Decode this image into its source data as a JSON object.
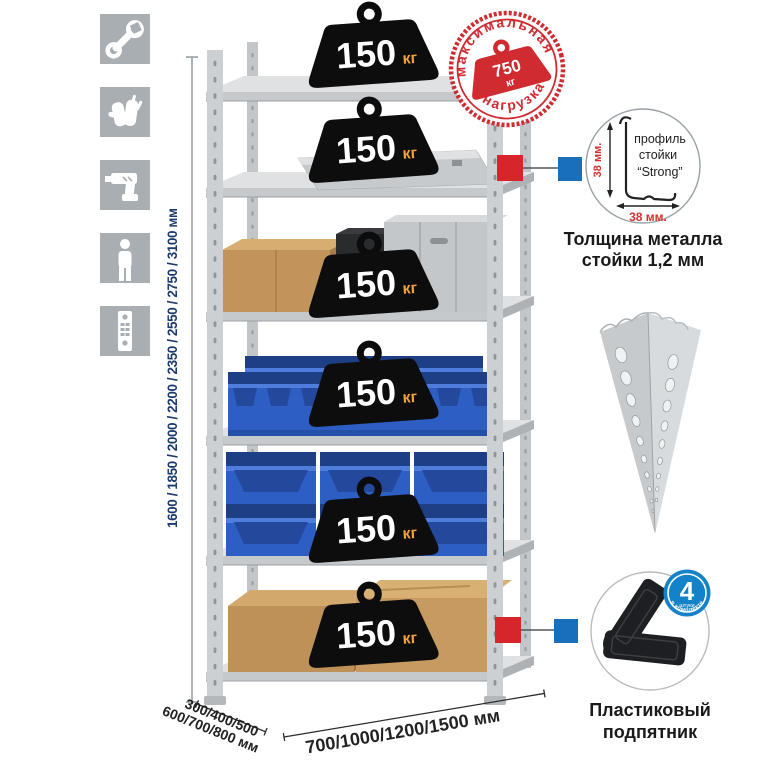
{
  "product": {
    "type": "metal-shelving-rack-infographic"
  },
  "assembly_icons": [
    {
      "name": "wrench"
    },
    {
      "name": "gloves"
    },
    {
      "name": "drill"
    },
    {
      "name": "person"
    },
    {
      "name": "perforated-post"
    }
  ],
  "dimensions": {
    "height_label": "1600 / 1850 / 2000 / 2200 / 2350 / 2550 / 2750 / 3100 мм",
    "depth_line1": "300/400/500",
    "depth_line2": "600/700/800 мм",
    "width_label": "700/1000/1200/1500 мм"
  },
  "rack": {
    "shelves": [
      {
        "load": "150",
        "unit": "кг"
      },
      {
        "load": "150",
        "unit": "кг"
      },
      {
        "load": "150",
        "unit": "кг"
      },
      {
        "load": "150",
        "unit": "кг"
      },
      {
        "load": "150",
        "unit": "кг"
      },
      {
        "load": "150",
        "unit": "кг"
      }
    ]
  },
  "max_load_stamp": {
    "arc_top": "максимальная",
    "arc_bottom": "нагрузка",
    "value": "750",
    "unit": "кг"
  },
  "profile_callout": {
    "label_line1": "профиль",
    "label_line2": "стойки",
    "label_line3": "“Strong”",
    "dim_vertical": "38 мм.",
    "dim_horizontal": "38 мм.",
    "caption_line1": "Толщина металла",
    "caption_line2": "стойки 1,2 мм"
  },
  "foot_callout": {
    "badge_number": "4",
    "badge_word": "штуки",
    "badge_arc": "в комплекте",
    "caption_line1": "Пластиковый",
    "caption_line2": "подпятник"
  },
  "colors": {
    "stamp_red": "#cf2b31",
    "connector_red": "#d6252b",
    "connector_blue": "#1a6fba",
    "badge_blue": "#1482c8",
    "bin_blue": "#2c5ec4",
    "dimension_navy": "#1c3a6d",
    "load_unit_orange": "#f0a236",
    "icon_gray": "#a9aeb3"
  }
}
